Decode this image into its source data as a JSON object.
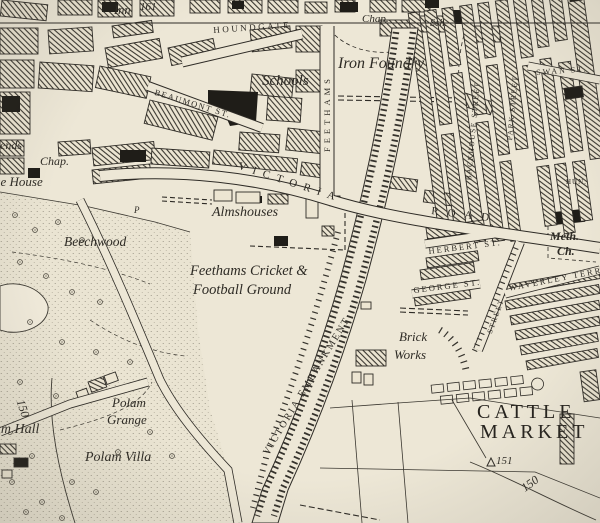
{
  "places": {
    "inn": "Inn",
    "chap_top": "Chap.",
    "sch_small": "Sch.",
    "schools": "Schools",
    "iron_foundry": "Iron Foundry",
    "hends_partial": "hends",
    "chap_west": "Chap.",
    "grange_house_partial": "ge House",
    "beechwood": "Beechwood",
    "almshouses": "Almshouses",
    "cricket_line1": "Feethams Cricket &",
    "cricket_line2": "Football Ground",
    "brick_line1": "Brick",
    "brick_line2": "Works",
    "meth_line1": "Meth.",
    "meth_line2": "Ch.",
    "cattle_line1": "CATTLE",
    "cattle_line2": "MARKET",
    "polam_grange_line1": "Polam",
    "polam_grange_line2": "Grange",
    "polam_hall_partial": "lam Hall",
    "polam_villa": "Polam Villa",
    "pump": "P"
  },
  "streets": {
    "houndgate": "HOUNDGATE",
    "beaumont": "BEAUMONT ST.",
    "feethams": "FEETHAMS",
    "victoria": "VICTORIA",
    "road": "ROAD",
    "victoria_embankment": "VICTORIA  EMBANKMENT",
    "herbert": "HERBERT ST.",
    "george": "GEORGE ST.",
    "waverley": "WAVERLEY TERRACE",
    "swan": "SWAN ST.",
    "park": "PARK STREET",
    "backhouse": "BACKHOUSE STREET",
    "street_diag": "STREET",
    "hun_partial": "HUN."
  },
  "elevations": {
    "spot_161": "161",
    "trig_151": "151",
    "contour_150_sw": "150",
    "contour_150_se": "150"
  },
  "colors": {
    "paper": "#ede7d6",
    "ink": "#37342e",
    "black": "#1f1d18"
  }
}
